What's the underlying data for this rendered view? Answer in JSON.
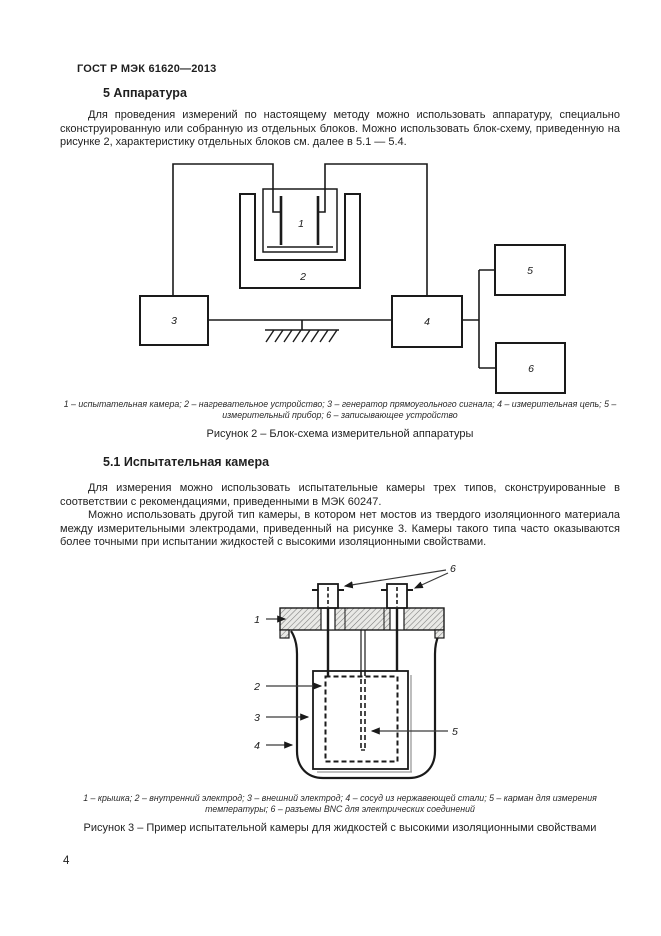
{
  "document": {
    "header": "ГОСТ Р МЭК 61620—2013",
    "page_number": "4"
  },
  "section_5": {
    "heading": "5 Аппаратура",
    "paragraph": "Для проведения измерений по настоящему методу можно использовать аппаратуру, специально сконструированную или собранную из отдельных блоков. Можно использовать блок-схему, приведенную на рисунке 2, характеристику отдельных блоков см. далее в 5.1 — 5.4."
  },
  "figure_2": {
    "legend": "1 – испытательная камера; 2 – нагревательное устройство; 3 – генератор прямоугольного сигнала; 4 – измерительная цепь; 5 – измерительный прибор; 6 – записывающее устройство",
    "caption": "Рисунок 2 – Блок-схема измерительной аппаратуры",
    "labels": {
      "chamber": "1",
      "heater": "2",
      "generator": "3",
      "measuring_circuit": "4",
      "meter": "5",
      "recorder": "6"
    }
  },
  "section_5_1": {
    "heading": "5.1 Испытательная камера",
    "paragraph_1": "Для измерения можно использовать испытательные камеры трех типов, сконструированные в соответствии с рекомендациями, приведенными в МЭК 60247.",
    "paragraph_2": "Можно использовать другой тип камеры, в котором нет мостов из твердого изоляционного материала между измерительными электродами, приведенный на рисунке 3. Камеры такого типа часто оказываются более точными при испытании жидкостей с высокими изоляционными свойствами."
  },
  "figure_3": {
    "legend": "1 – крышка; 2 – внутренний электрод; 3 – внешний электрод; 4 – сосуд из нержавеющей стали; 5 – карман для измерения температуры; 6 – разъемы BNC для электрических соединений",
    "caption": "Рисунок 3 – Пример испытательной камеры для жидкостей с высокими изоляционными свойствами",
    "labels": {
      "lid": "1",
      "inner_electrode": "2",
      "outer_electrode": "3",
      "vessel": "4",
      "temperature_pocket": "5",
      "bnc_connectors": "6"
    }
  },
  "colors": {
    "ink": "#1a1a1a",
    "paper": "#ffffff"
  }
}
